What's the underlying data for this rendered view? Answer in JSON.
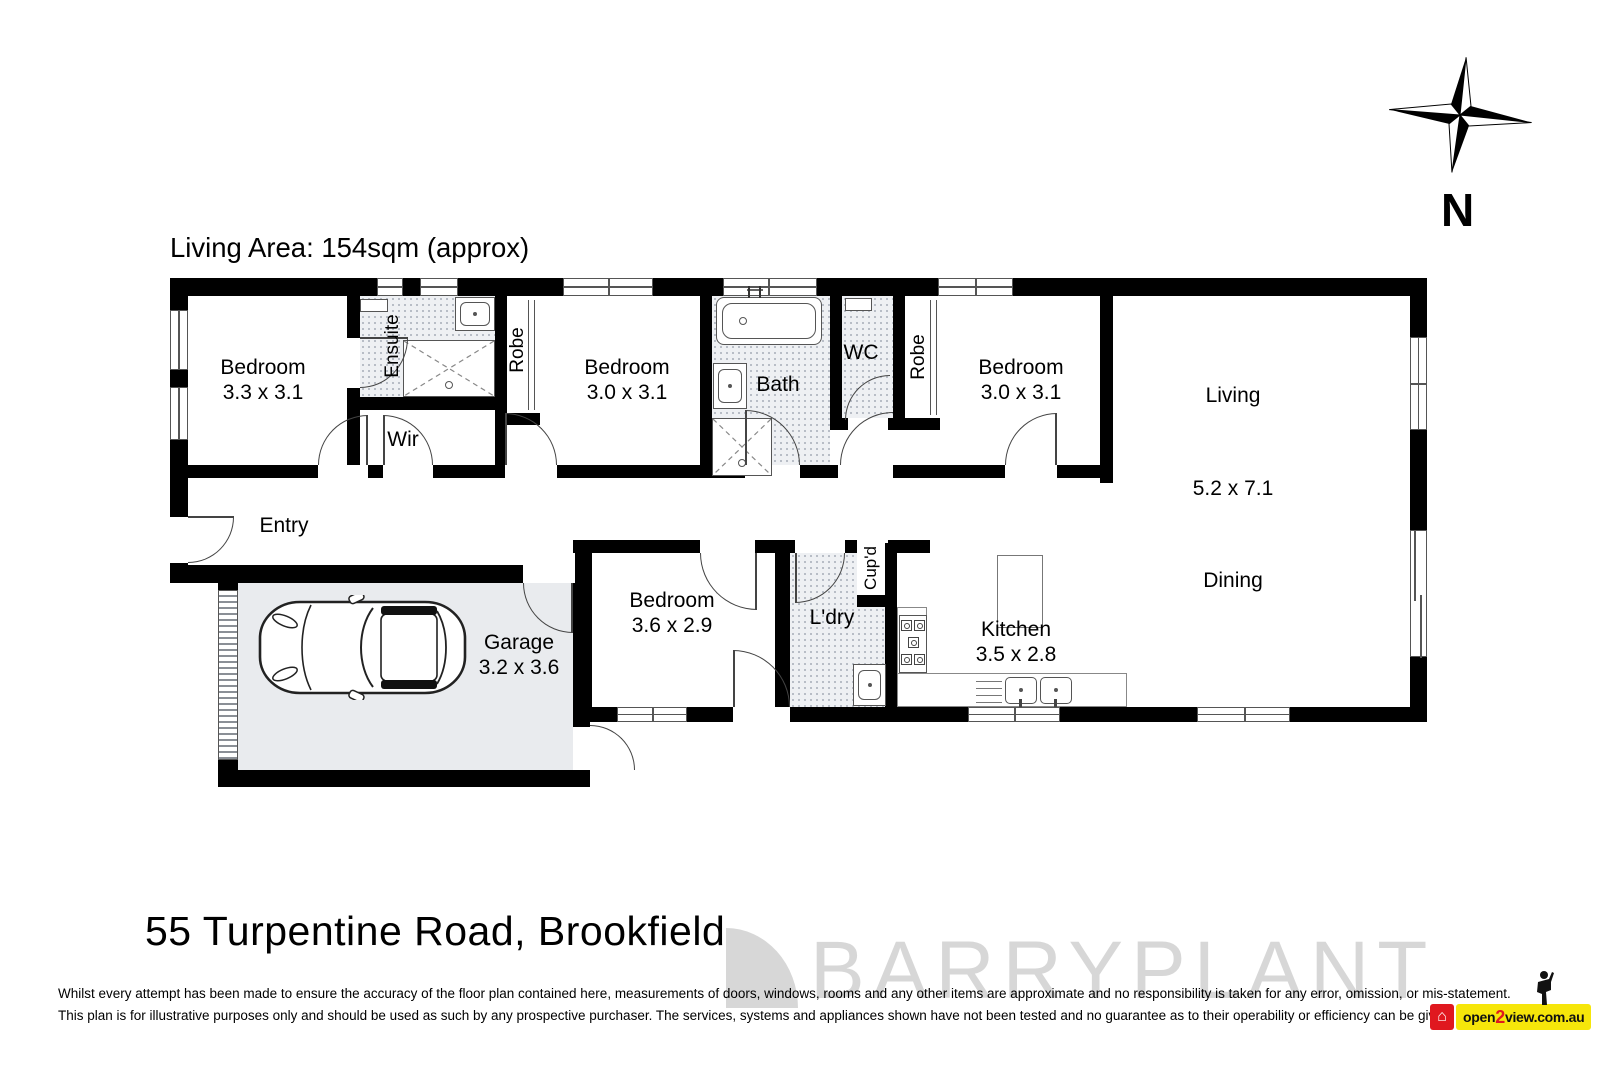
{
  "header": {
    "living_area": "Living Area: 154sqm (approx)"
  },
  "compass": {
    "north_label": "N"
  },
  "rooms": {
    "bedroom1": {
      "name": "Bedroom",
      "dims": "3.3 x 3.1"
    },
    "ensuite": {
      "name": "Ensuite"
    },
    "wir": {
      "name": "Wir"
    },
    "robe1": {
      "name": "Robe"
    },
    "bedroom2": {
      "name": "Bedroom",
      "dims": "3.0 x 3.1"
    },
    "bath": {
      "name": "Bath"
    },
    "wc": {
      "name": "WC"
    },
    "robe2": {
      "name": "Robe"
    },
    "bedroom3": {
      "name": "Bedroom",
      "dims": "3.0 x 3.1"
    },
    "living": {
      "name": "Living",
      "dims": "5.2 x 7.1"
    },
    "dining": {
      "name": "Dining"
    },
    "entry": {
      "name": "Entry"
    },
    "garage": {
      "name": "Garage",
      "dims": "3.2 x 3.6"
    },
    "bedroom4": {
      "name": "Bedroom",
      "dims": "3.6 x 2.9"
    },
    "laundry": {
      "name": "L'dry"
    },
    "cupboard": {
      "name": "Cup'd"
    },
    "kitchen": {
      "name": "Kitchen",
      "dims": "3.5 x 2.8"
    }
  },
  "footer": {
    "address": "55 Turpentine Road, Brookfield",
    "disclaimer_line1": "Whilst every attempt has been made to ensure the accuracy of the floor plan contained here, measurements of doors, windows, rooms and any other items are approximate and no responsibility is taken for any error, omission, or mis-statement.",
    "disclaimer_line2": "This plan is for illustrative purposes only and should be used as such by any prospective purchaser. The services, systems and appliances shown have not been tested and no guarantee as to their operability or efficiency can be given."
  },
  "watermark": {
    "brand": "BARRYPLANT"
  },
  "logo": {
    "open": "open",
    "two": "2",
    "view": "view.com.au"
  },
  "colors": {
    "wall": "#000000",
    "garage_floor": "#e9ebee",
    "wet_floor": "#eef0f3",
    "watermark": "#d7d7d7",
    "logo_yellow": "#f6e60a",
    "logo_red": "#e0181f"
  }
}
